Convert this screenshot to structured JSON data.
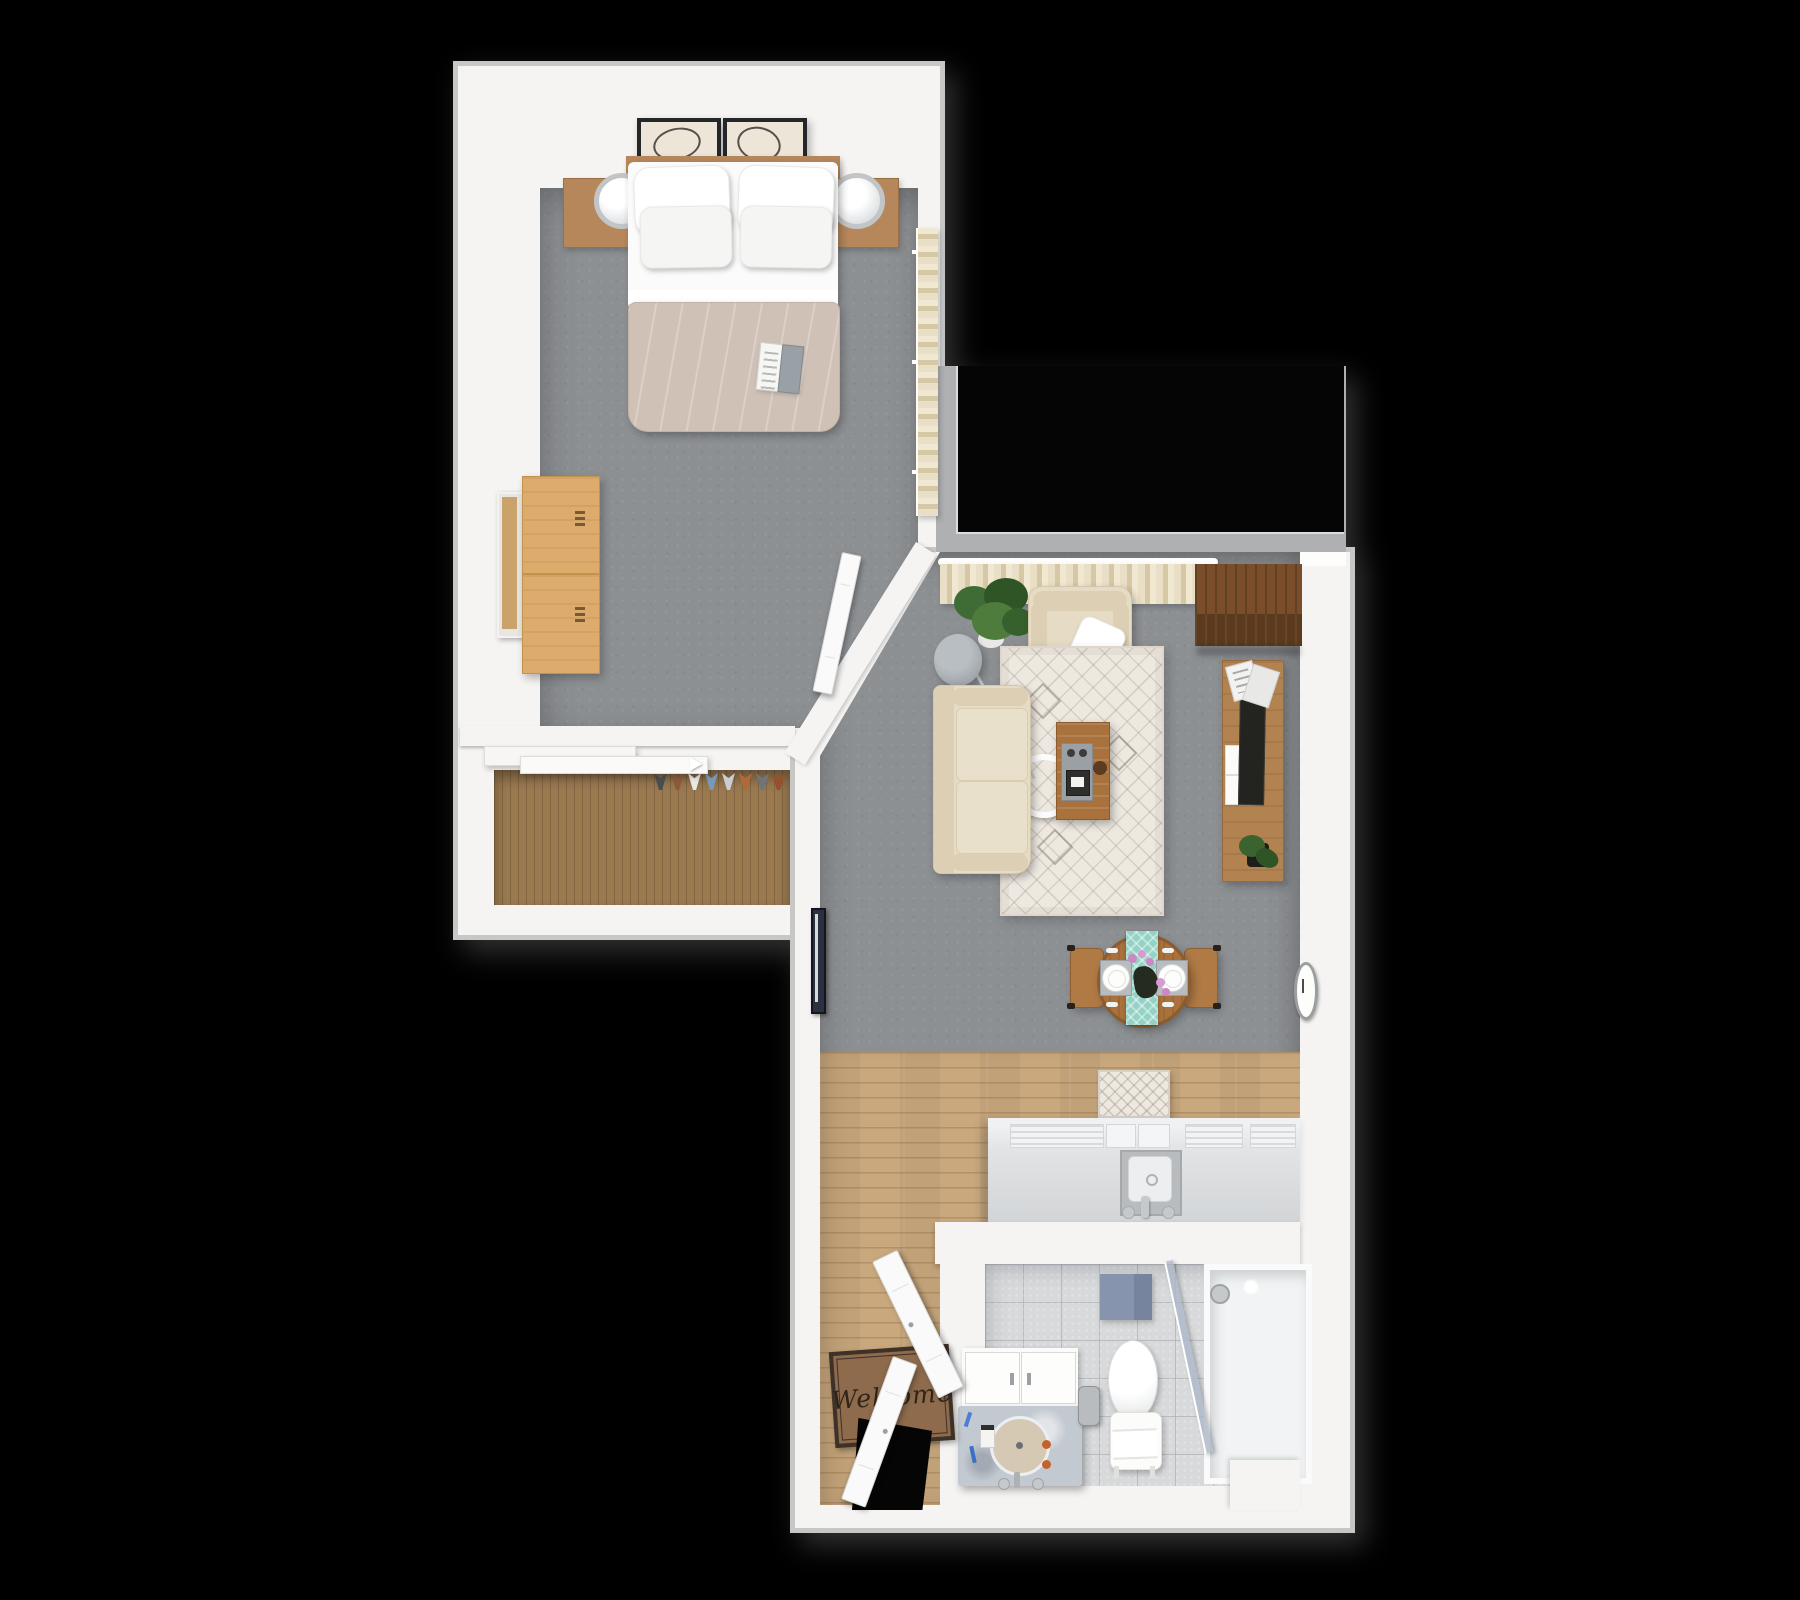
{
  "title": "3D rendered top-down floor plan of a one-bedroom apartment",
  "entry": {
    "doormat_text": "Welcome"
  },
  "colors": {
    "background": "#000000",
    "wall": "#f5f4f2",
    "wall_edge": "#c7c7c5",
    "bay": "#aeb0b2",
    "void": "#050505",
    "carpet": "#8d9093",
    "wood_floor": "#c9a87d",
    "closet_wood": "#9b7a50",
    "duvet": "#cfc1b6",
    "sheet": "#fbfbfb",
    "headboard_wood": "#b5875a",
    "dresser_wood": "#ddab6c",
    "sofa": "#e6dcc6",
    "sofa_dark": "#dccfb4",
    "rug": "#ede8e0",
    "curtain_light": "#e9dfc6",
    "curtain_dark": "#d6c8a4",
    "cabinet_wood": "#7a4e2a",
    "cabinet_front": "#5c3a1e",
    "console_wood": "#b28350",
    "tv": "#23231f",
    "table_wood": "#a9713c",
    "chair_wood": "#b07a45",
    "runner_teal": "#94d2c6",
    "flower_pink": "#cd87c6",
    "leaf_green": "#3f6b34",
    "lamp_gray": "#979da1",
    "counter": "#e2e4e6",
    "counter_face": "#d2d5d7",
    "tile": "#d7d9db",
    "marble": "#c3c9d1",
    "basin": "#d6c9b4",
    "towel_blue": "#8694ae",
    "mat_brown": "#8d6b4c",
    "mat_border": "#3e3128",
    "door": "#fbfafa",
    "art_frame": "#24262a"
  },
  "rooms": [
    {
      "id": "bedroom",
      "label": "Bedroom",
      "furniture": [
        "double bed",
        "four white pillows",
        "beige duvet",
        "open magazine",
        "wooden headboard",
        "two nightstands",
        "two ring table lamps",
        "two framed abstract artworks",
        "oak dresser",
        "leaning mirror",
        "sliding-door closet",
        "hanging clothes",
        "curtained window",
        "open interior door"
      ]
    },
    {
      "id": "living-room",
      "label": "Living room",
      "furniture": [
        "beige sofa",
        "armchair with throw pillow",
        "potted plant",
        "arc floor lamp with ring",
        "patterned area rug",
        "wooden coffee table with tray",
        "dark corner cabinet",
        "media console with TV, magazines and plant",
        "wall clock",
        "narrow wall art",
        "wide window with curtains"
      ]
    },
    {
      "id": "dining-area",
      "label": "Dining area",
      "furniture": [
        "round dining table",
        "teal table runner",
        "two place settings",
        "flower centerpiece",
        "two wooden chairs"
      ]
    },
    {
      "id": "kitchen",
      "label": "Kitchen",
      "furniture": [
        "counter with cooktop grates",
        "kitchen sink with faucet",
        "patterned kitchen mat",
        "plank wood flooring"
      ]
    },
    {
      "id": "entry",
      "label": "Entry",
      "furniture": [
        "open double front door",
        "welcome doormat"
      ]
    },
    {
      "id": "bathroom",
      "label": "Bathroom",
      "furniture": [
        "vanity with round sink",
        "toiletries",
        "toilet with towel",
        "trash can",
        "glass shower screen",
        "shower head",
        "wall-hung blue towel"
      ]
    }
  ]
}
